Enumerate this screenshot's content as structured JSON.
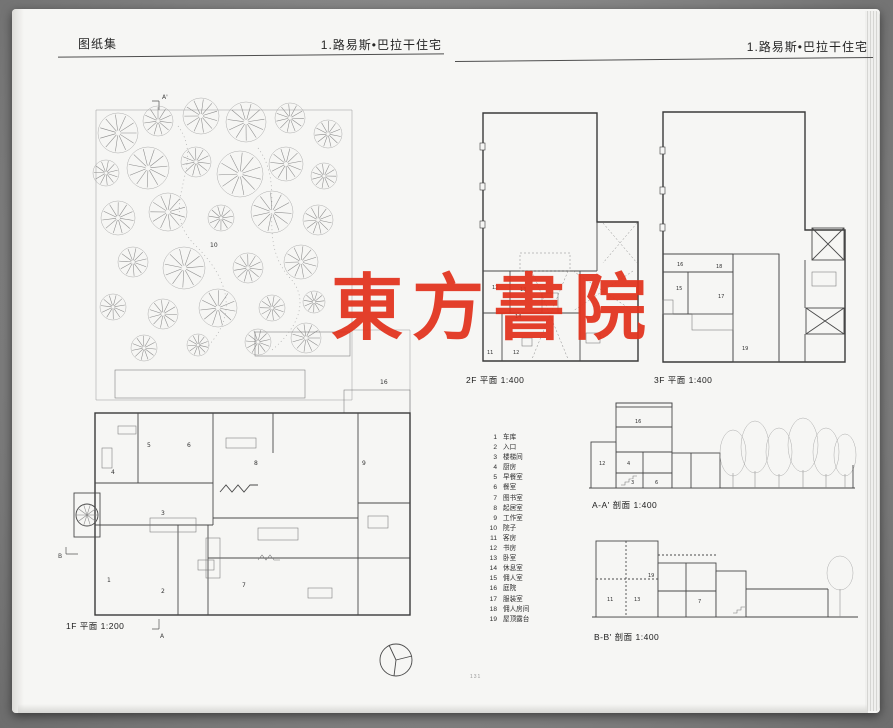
{
  "watermark": {
    "text": "東方書院",
    "color": "#e2321c"
  },
  "page_left": {
    "header": {
      "section": "图纸集",
      "title": "1.路易斯•巴拉干住宅"
    },
    "plan_1f": {
      "caption": "1F 平面 1:200",
      "room_numbers": [
        "1",
        "2",
        "3",
        "4",
        "5",
        "6",
        "7",
        "8",
        "9",
        "10",
        "16"
      ],
      "markers": {
        "a_top": "A'",
        "a_bottom": "A",
        "b_left": "B"
      }
    }
  },
  "page_right": {
    "header": {
      "title": "1.路易斯•巴拉干住宅"
    },
    "plan_2f": {
      "caption": "2F 平面 1:400",
      "room_numbers": [
        "12",
        "13",
        "14",
        "11",
        "12"
      ]
    },
    "plan_3f": {
      "caption": "3F 平面 1:400",
      "room_numbers": [
        "15",
        "18",
        "17",
        "16",
        "19"
      ]
    },
    "section_aa": {
      "caption": "A-A' 剖面 1:400",
      "room_numbers": [
        "16",
        "12",
        "4",
        "3",
        "6"
      ]
    },
    "section_bb": {
      "caption": "B-B' 剖面 1:400",
      "room_numbers": [
        "19",
        "11",
        "13",
        "7"
      ]
    },
    "legend": {
      "items": [
        {
          "num": "1",
          "label": "车库"
        },
        {
          "num": "2",
          "label": "入口"
        },
        {
          "num": "3",
          "label": "楼梯间"
        },
        {
          "num": "4",
          "label": "厨房"
        },
        {
          "num": "5",
          "label": "早餐室"
        },
        {
          "num": "6",
          "label": "餐室"
        },
        {
          "num": "7",
          "label": "图书室"
        },
        {
          "num": "8",
          "label": "起居室"
        },
        {
          "num": "9",
          "label": "工作室"
        },
        {
          "num": "10",
          "label": "院子"
        },
        {
          "num": "11",
          "label": "客房"
        },
        {
          "num": "12",
          "label": "书房"
        },
        {
          "num": "13",
          "label": "卧室"
        },
        {
          "num": "14",
          "label": "休息室"
        },
        {
          "num": "15",
          "label": "佣人室"
        },
        {
          "num": "16",
          "label": "庭院"
        },
        {
          "num": "17",
          "label": "服装室"
        },
        {
          "num": "18",
          "label": "佣人房间"
        },
        {
          "num": "19",
          "label": "屋顶露台"
        }
      ]
    },
    "page_number": "131"
  }
}
